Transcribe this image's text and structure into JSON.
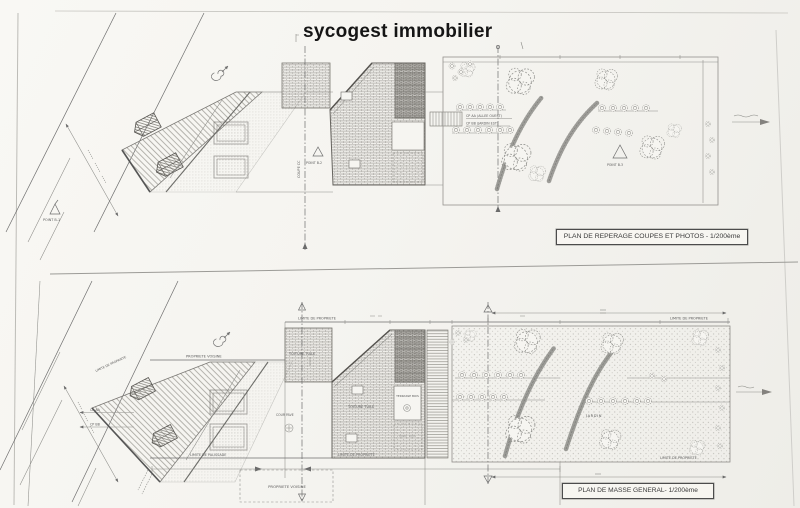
{
  "page": {
    "title": "sycogest immobilier",
    "paper_color": "#f6f5f1",
    "ink_color": "#555555"
  },
  "top_plan": {
    "caption": "PLAN DE REPERAGE COUPES ET PHOTOS - 1/200ème",
    "labels": {
      "coupe_cc": "COUPE CC",
      "point_b1": "POINT B-1",
      "point_b2": "POINT B-2",
      "point_b3": "POINT B-3",
      "cp_aa_allee": "CP AA (ALLEE OUEST)",
      "cp_bb_jardin": "CP BB (JARDIN EST)"
    }
  },
  "bottom_plan": {
    "caption": "PLAN DE MASSE GENERAL- 1/200ème",
    "labels": {
      "jardin": "JARDIN",
      "toiture_tuile": "TOITURE TUILE",
      "terrasse_bois": "TERRASSE BOIS",
      "cour_pave": "COUR PAVE"
    }
  },
  "shared_labels": {
    "limite_propriete": "LIMITE DE PROPRIETE",
    "limite_palissade": "LIMITE DE PALISSADE",
    "propriete_voisine": "PROPRIETE VOISINE",
    "cp_aa": "CP AA",
    "cp_bb": "CP BB"
  }
}
